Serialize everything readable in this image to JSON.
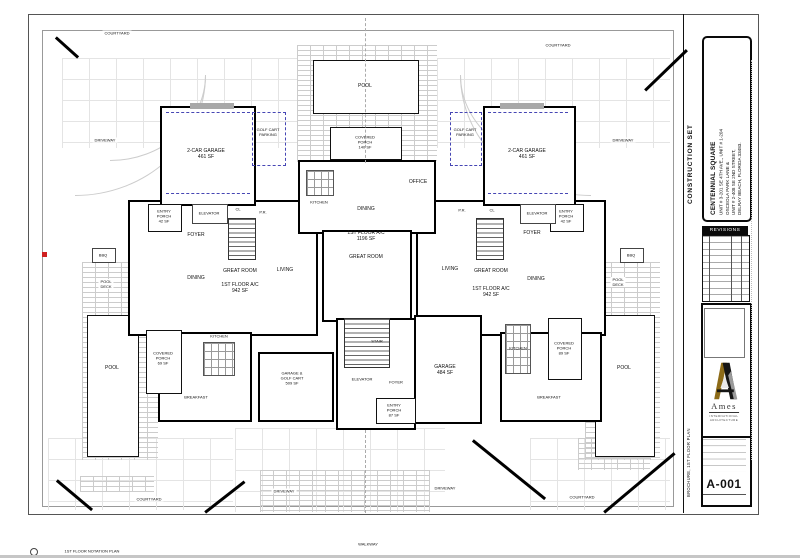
{
  "titleblock": {
    "construction_set": "CONSTRUCTION SET",
    "project_name": "CENTENNIAL SQUARE",
    "address_line1": "UNIT # 3-201 SE 4TH AVE., UNIT # 1-204",
    "address_line2": "OSCEOLA PARK LANE &",
    "address_line3": "UNIT # 2-408 SE 2ND STREET,",
    "address_line4": "DELRAY BEACH, FLORIDA 33483.",
    "revisions_title": "REVISIONS",
    "firm_name": "Ames",
    "firm_sub1": "INTERNATIONAL",
    "firm_sub2": "ARCHITECTURE",
    "sheet_number": "A-001",
    "drawing_title": "BROCHURE, 1ST FLOOR PLAN"
  },
  "site": {
    "courtyard": "COURTYARD",
    "driveway": "DRIVEWAY",
    "walkway": "WALKWAY",
    "pool": "POOL",
    "pool_deck": "POOL\nDECK",
    "bbq": "BBQ",
    "notation_callout": "1ST FLOOR NOTATION PLAN"
  },
  "left_unit": {
    "garage": "2-CAR GARAGE\n461 SF",
    "golf_cart": "GOLF CART\nPARKING",
    "entry_porch": "ENTRY\nPORCH\n42 SF",
    "elevator": "ELEVATOR",
    "foyer": "FOYER",
    "dining": "DINING",
    "great_room": "GREAT ROOM",
    "ac": "1ST FLOOR A/C\n942 SF",
    "living": "LIVING",
    "kitchen": "KITCHEN",
    "breakfast": "BREAKFAST",
    "covered_porch": "COVERED\nPORCH\n69 SF",
    "closet": "CL",
    "powder_room": "P.R."
  },
  "right_unit": {
    "garage": "2-CAR GARAGE\n461 SF",
    "golf_cart": "GOLF CART\nPARKING",
    "entry_porch": "ENTRY\nPORCH\n42 SF",
    "elevator": "ELEVATOR",
    "foyer": "FOYER",
    "dining": "DINING",
    "great_room": "GREAT ROOM",
    "ac": "1ST FLOOR A/C\n942 SF",
    "living": "LIVING",
    "kitchen": "KITCHEN",
    "breakfast": "BREAKFAST",
    "covered_porch": "COVERED\nPORCH\n89 SF",
    "closet": "CL",
    "powder_room": "P.R."
  },
  "center_unit": {
    "office": "OFFICE",
    "kitchen": "KITCHEN",
    "dining": "DINING",
    "ac": "1ST FLOOR A/C\n1196 SF",
    "great_room": "GREAT ROOM",
    "stair": "STAIR",
    "elevator": "ELEVATOR",
    "foyer": "FOYER",
    "entry_porch": "ENTRY\nPORCH\n87 SF",
    "garage_golf_cart": "GARAGE &\nGOLF CART\n509 SF",
    "garage": "GARAGE\n484 SF",
    "covered_porch": "COVERED\nPORCH\n140 SF"
  }
}
